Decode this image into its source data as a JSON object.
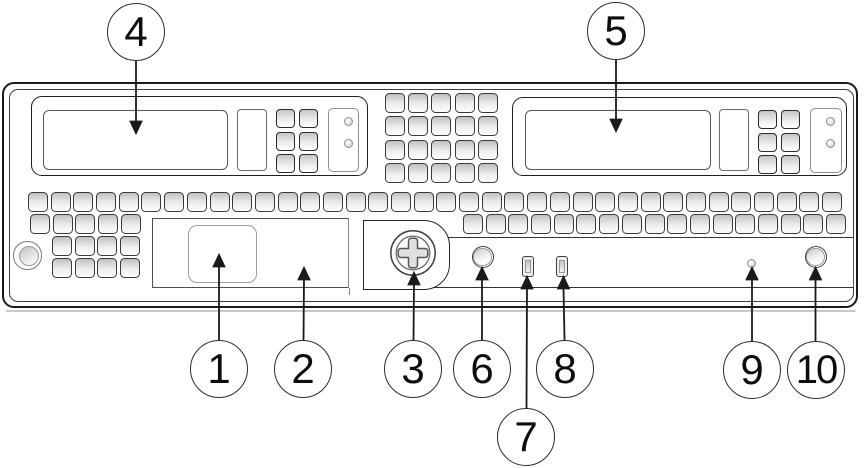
{
  "colors": {
    "line": "#1a1a1a",
    "panel_fill": "#ffffff",
    "vent_shade": "#c0c0c0"
  },
  "callouts": [
    {
      "label": "1"
    },
    {
      "label": "2"
    },
    {
      "label": "3"
    },
    {
      "label": "4"
    },
    {
      "label": "5"
    },
    {
      "label": "6"
    },
    {
      "label": "7"
    },
    {
      "label": "8"
    },
    {
      "label": "9"
    },
    {
      "label": "10"
    }
  ]
}
